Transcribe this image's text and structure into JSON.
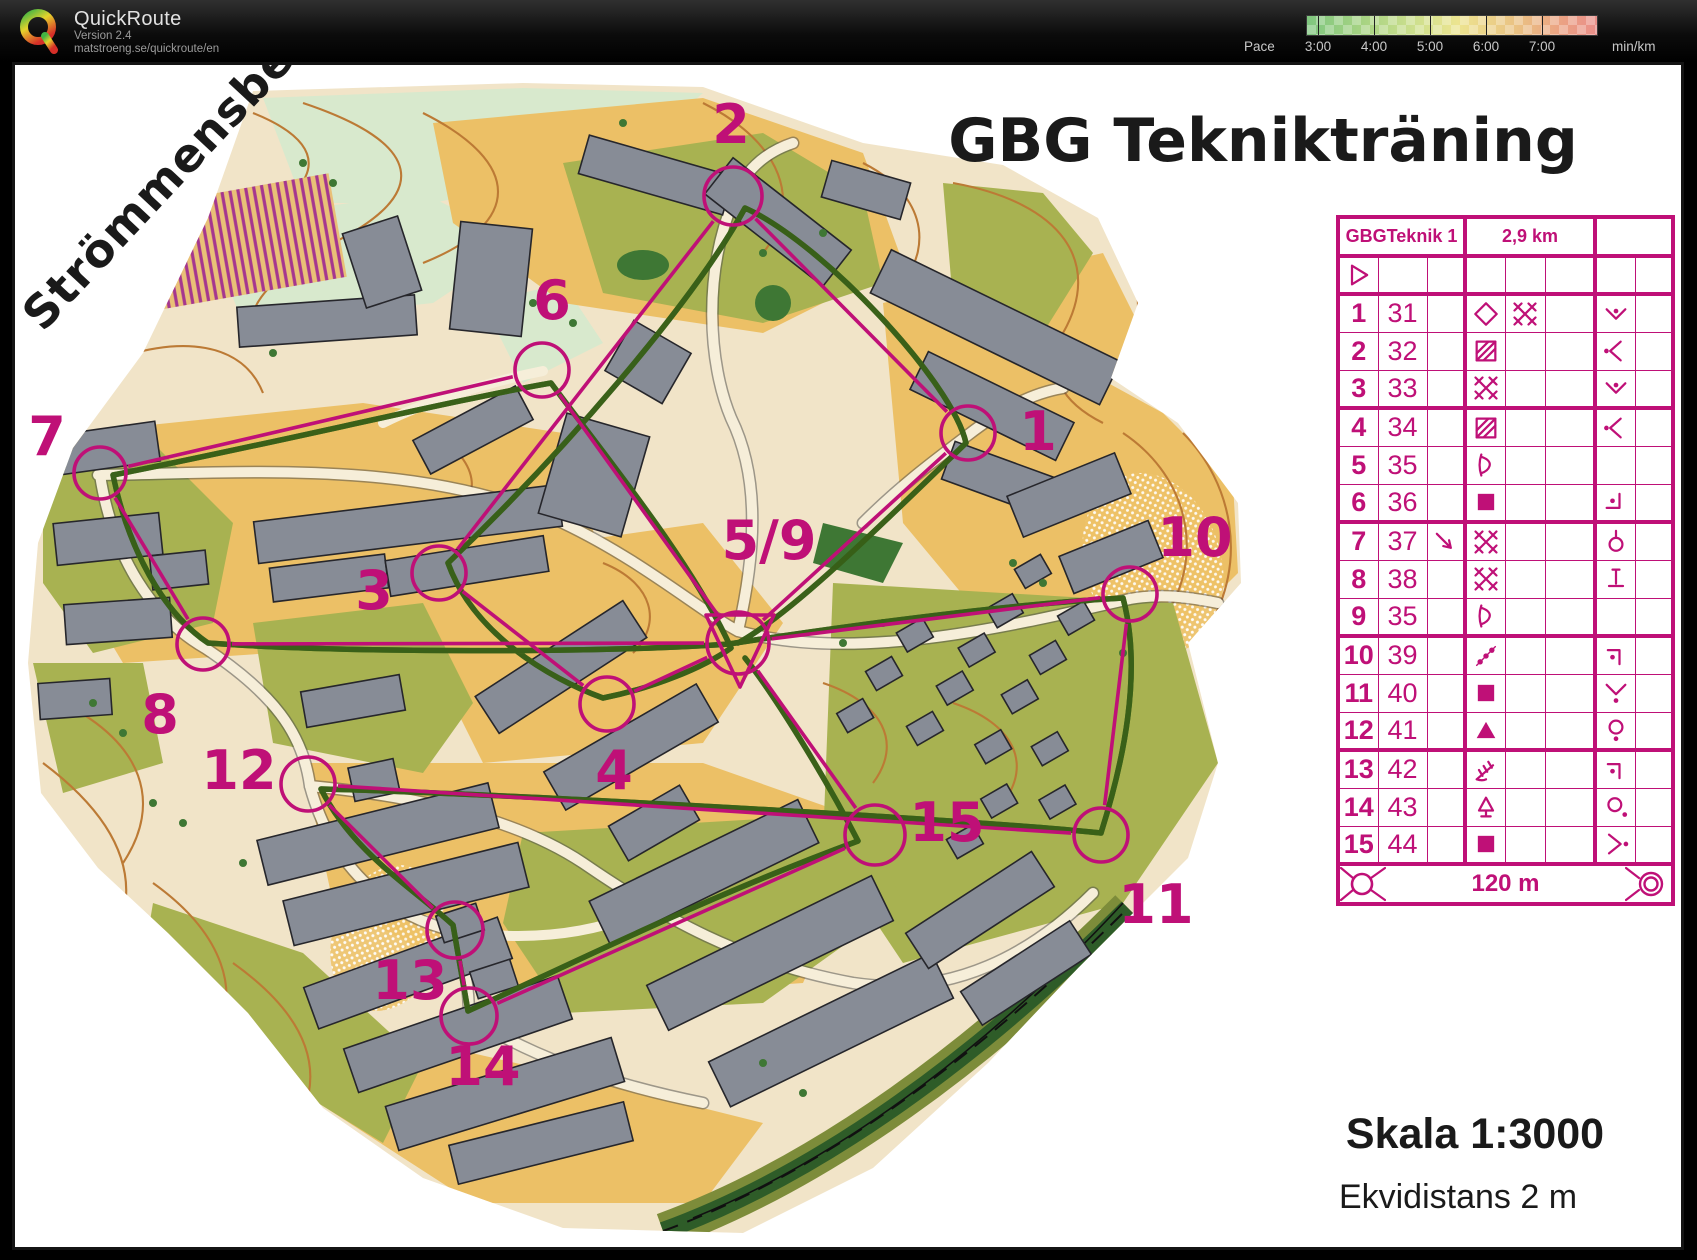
{
  "header": {
    "app_name": "QuickRoute",
    "version": "Version 2.4",
    "url": "matstroeng.se/quickroute/en",
    "pace_label": "Pace",
    "pace_unit": "min/km",
    "pace_ticks": [
      {
        "label": "3:00",
        "x": 1318
      },
      {
        "label": "4:00",
        "x": 1374
      },
      {
        "label": "5:00",
        "x": 1430
      },
      {
        "label": "6:00",
        "x": 1486
      },
      {
        "label": "7:00",
        "x": 1542
      }
    ],
    "legend_colors": [
      "#7fc67f",
      "#cfe08e",
      "#ece490",
      "#eac283",
      "#e98f8a"
    ]
  },
  "map": {
    "place_label": "Strömmensberg",
    "title": "GBG Teknikträning",
    "scale_label": "Skala 1:3000",
    "equidistance_label": "Ekvidistans 2 m",
    "course_color": "#bf1077",
    "controls": [
      {
        "id": "c59",
        "label": "5/9",
        "x": 735,
        "y": 640,
        "r": 31,
        "lx": 766,
        "ly": 556,
        "start": true
      },
      {
        "id": "1",
        "label": "1",
        "x": 965,
        "y": 430,
        "r": 27,
        "lx": 1035,
        "ly": 447
      },
      {
        "id": "2",
        "label": "2",
        "x": 730,
        "y": 193,
        "r": 29,
        "lx": 728,
        "ly": 140
      },
      {
        "id": "3",
        "label": "3",
        "x": 436,
        "y": 570,
        "r": 27,
        "lx": 371,
        "ly": 606
      },
      {
        "id": "4",
        "label": "4",
        "x": 604,
        "y": 701,
        "r": 27,
        "lx": 611,
        "ly": 786
      },
      {
        "id": "6",
        "label": "6",
        "x": 539,
        "y": 367,
        "r": 27,
        "lx": 549,
        "ly": 316
      },
      {
        "id": "7",
        "label": "7",
        "x": 97,
        "y": 470,
        "r": 26,
        "lx": 44,
        "ly": 452
      },
      {
        "id": "8",
        "label": "8",
        "x": 200,
        "y": 641,
        "r": 26,
        "lx": 157,
        "ly": 730
      },
      {
        "id": "10",
        "label": "10",
        "x": 1127,
        "y": 591,
        "r": 27,
        "lx": 1192,
        "ly": 553
      },
      {
        "id": "11",
        "label": "11",
        "x": 1098,
        "y": 832,
        "r": 27,
        "lx": 1153,
        "ly": 920
      },
      {
        "id": "12",
        "label": "12",
        "x": 305,
        "y": 781,
        "r": 27,
        "lx": 236,
        "ly": 786
      },
      {
        "id": "13",
        "label": "13",
        "x": 452,
        "y": 927,
        "r": 28,
        "lx": 407,
        "ly": 996
      },
      {
        "id": "14",
        "label": "14",
        "x": 466,
        "y": 1013,
        "r": 28,
        "lx": 480,
        "ly": 1082
      },
      {
        "id": "15",
        "label": "15",
        "x": 872,
        "y": 832,
        "r": 30,
        "lx": 944,
        "ly": 838
      }
    ],
    "course_segments": [
      [
        "c59",
        "1"
      ],
      [
        "1",
        "2"
      ],
      [
        "2",
        "3"
      ],
      [
        "3",
        "4"
      ],
      [
        "4",
        "c59"
      ],
      [
        "c59",
        "6"
      ],
      [
        "6",
        "7"
      ],
      [
        "7",
        "8"
      ],
      [
        "8",
        "c59"
      ],
      [
        "c59",
        "10"
      ],
      [
        "10",
        "11"
      ],
      [
        "11",
        "12"
      ],
      [
        "12",
        "13"
      ],
      [
        "13",
        "14"
      ],
      [
        "14",
        "15"
      ],
      [
        "15",
        "c59"
      ]
    ]
  },
  "control_card": {
    "course_name": "GBGTeknik 1",
    "course_length": "2,9 km",
    "finish_text": "120 m",
    "rows": [
      {
        "num": "1",
        "code": "31",
        "c": "",
        "d": "diamond-open",
        "e": "crosshatch",
        "f": "",
        "g": "v-dot-inside",
        "h": ""
      },
      {
        "num": "2",
        "code": "32",
        "c": "",
        "d": "square-hatched",
        "e": "",
        "f": "",
        "g": "tip-left-dot",
        "h": ""
      },
      {
        "num": "3",
        "code": "33",
        "c": "",
        "d": "crosshatch",
        "e": "",
        "f": "",
        "g": "v-dot-inside",
        "h": ""
      },
      {
        "num": "4",
        "code": "34",
        "c": "",
        "d": "square-hatched",
        "e": "",
        "f": "",
        "g": "tip-left-dot",
        "h": ""
      },
      {
        "num": "5",
        "code": "35",
        "c": "",
        "d": "curve-wall",
        "e": "",
        "f": "",
        "g": "",
        "h": ""
      },
      {
        "num": "6",
        "code": "36",
        "c": "",
        "d": "square-filled",
        "e": "",
        "f": "",
        "g": "corner-inside-dot",
        "h": ""
      },
      {
        "num": "7",
        "code": "37",
        "c": "arrow-se",
        "d": "crosshatch",
        "e": "",
        "f": "",
        "g": "circle-stem",
        "h": ""
      },
      {
        "num": "8",
        "code": "38",
        "c": "",
        "d": "crosshatch",
        "e": "",
        "f": "",
        "g": "foot",
        "h": ""
      },
      {
        "num": "9",
        "code": "35",
        "c": "",
        "d": "curve-wall",
        "e": "",
        "f": "",
        "g": "",
        "h": ""
      },
      {
        "num": "10",
        "code": "39",
        "c": "",
        "d": "dotted-diagonal",
        "e": "",
        "f": "",
        "g": "corner-dot",
        "h": ""
      },
      {
        "num": "11",
        "code": "40",
        "c": "",
        "d": "square-filled",
        "e": "",
        "f": "",
        "g": "v-dot-below",
        "h": ""
      },
      {
        "num": "12",
        "code": "41",
        "c": "",
        "d": "triangle-filled",
        "e": "",
        "f": "",
        "g": "circle-dot-below",
        "h": ""
      },
      {
        "num": "13",
        "code": "42",
        "c": "",
        "d": "fence",
        "e": "",
        "f": "",
        "g": "corner-dot",
        "h": ""
      },
      {
        "num": "14",
        "code": "43",
        "c": "",
        "d": "tree",
        "e": "",
        "f": "",
        "g": "circle-dot-se",
        "h": ""
      },
      {
        "num": "15",
        "code": "44",
        "c": "",
        "d": "square-filled",
        "e": "",
        "f": "",
        "g": "chevron-right-dot",
        "h": ""
      }
    ]
  }
}
